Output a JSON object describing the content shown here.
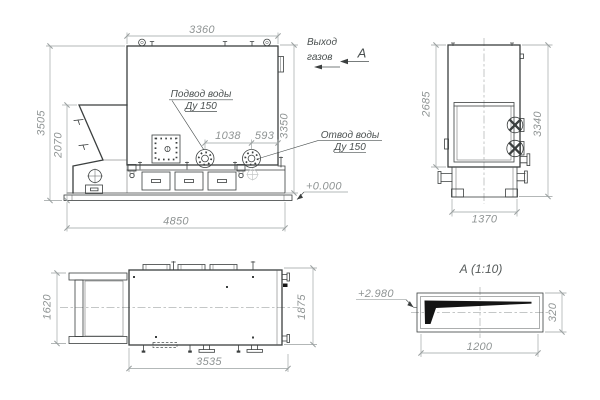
{
  "side_view": {
    "dims": {
      "top_width": "3360",
      "overall_height": "3505",
      "hopper_height": "2070",
      "body_height": "3350",
      "nozzle_spacing": "1038",
      "nozzle_edge": "593",
      "base_length": "4850"
    },
    "labels": {
      "supply1": "Подвод воды",
      "supply2": "Ду 150",
      "return1": "Отвод воды",
      "return2": "Ду 150",
      "gas1": "Выход",
      "gas2": "газов",
      "view_letter": "А",
      "level": "+0.000"
    }
  },
  "front_view": {
    "dims": {
      "upper_height": "2685",
      "overall_height": "3340",
      "base_width": "1370"
    }
  },
  "plan_view": {
    "dims": {
      "grate_width": "1620",
      "overall_width": "1875",
      "body_length": "3535"
    }
  },
  "detail_view": {
    "title": "А (1:10)",
    "dims": {
      "length": "1200",
      "height": "320"
    },
    "level": "+2.980"
  },
  "colors": {
    "background": "#ffffff",
    "line": "#3b3f3f",
    "dimension": "#9aa0a0",
    "label": "#4a5050",
    "black_fill": "#141414"
  }
}
